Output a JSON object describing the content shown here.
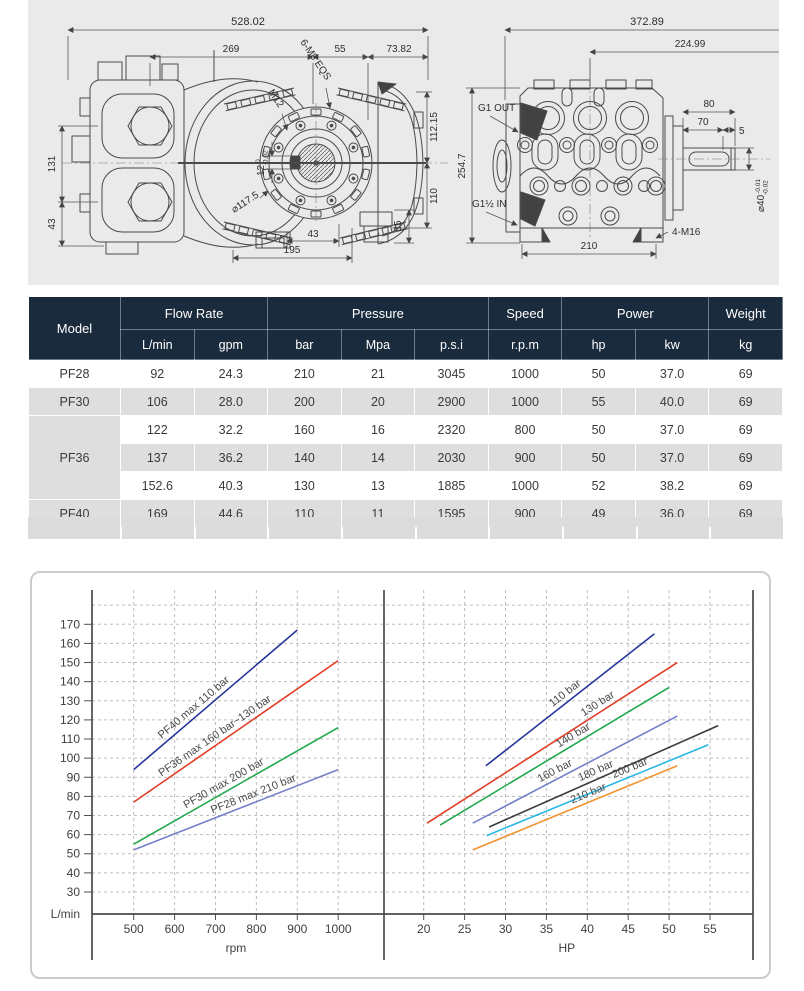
{
  "drawings": {
    "side_view": {
      "dim_overall_length": "528.02",
      "dim_mid_length": "269",
      "dim_flange_offset": "55",
      "dim_end_length": "73.82",
      "dim_left_height": "131",
      "dim_left_foot": "43",
      "dim_right_upper": "112.15",
      "dim_right_lower": "110",
      "dim_foot_height": "35",
      "dim_bottom_small": "43",
      "dim_bottom_span": "195",
      "label_bolt_pattern": "6-M8 EQS",
      "label_thread": "M12",
      "label_flange_dia": "⌀117.5",
      "label_key_width": "12",
      "label_key_tol_upper": "0",
      "label_key_tol_lower": "-0.02"
    },
    "front_view": {
      "dim_overall_width": "372.89",
      "dim_inner_width": "224.99",
      "dim_overall_height": "254.7",
      "dim_shaft_length": "80",
      "dim_key_length": "70",
      "dim_shaft_end": "5",
      "label_shaft_dia": "⌀40",
      "label_shaft_tol_upper": "-0.01",
      "label_shaft_tol_lower": "-0.02",
      "label_outlet": "G1 OUT",
      "label_inlet": "G1½ IN",
      "label_foot_bolts": "4-M16",
      "dim_foot_span": "210"
    }
  },
  "table": {
    "header_color": "#1b2b3e",
    "groups": {
      "model": "Model",
      "flow": "Flow Rate",
      "pressure": "Pressure",
      "speed": "Speed",
      "power": "Power",
      "weight": "Weight"
    },
    "units": [
      "L/min",
      "gpm",
      "bar",
      "Mpa",
      "p.s.i",
      "r.p.m",
      "hp",
      "kw",
      "kg"
    ],
    "rows": [
      {
        "model": "PF28",
        "values": [
          [
            "92",
            "24.3",
            "210",
            "21",
            "3045",
            "1000",
            "50",
            "37.0",
            "69"
          ]
        ]
      },
      {
        "model": "PF30",
        "values": [
          [
            "106",
            "28.0",
            "200",
            "20",
            "2900",
            "1000",
            "55",
            "40.0",
            "69"
          ]
        ]
      },
      {
        "model": "PF36",
        "values": [
          [
            "122",
            "32.2",
            "160",
            "16",
            "2320",
            "800",
            "50",
            "37.0",
            "69"
          ],
          [
            "137",
            "36.2",
            "140",
            "14",
            "2030",
            "900",
            "50",
            "37.0",
            "69"
          ],
          [
            "152.6",
            "40.3",
            "130",
            "13",
            "1885",
            "1000",
            "52",
            "38.2",
            "69"
          ]
        ]
      },
      {
        "model": "PF40",
        "values": [
          [
            "169",
            "44.6",
            "110",
            "11",
            "1595",
            "900",
            "49",
            "36.0",
            "69"
          ]
        ]
      }
    ]
  },
  "chart_data": [
    {
      "type": "line",
      "panel": "left",
      "xlabel": "rpm",
      "ylabel": "L/min",
      "x_ticks": [
        500,
        600,
        700,
        800,
        900,
        1000
      ],
      "y_ticks": [
        30,
        40,
        50,
        60,
        70,
        80,
        90,
        100,
        110,
        120,
        130,
        140,
        150,
        160,
        170
      ],
      "xlim": [
        400,
        1110
      ],
      "ylim": [
        18,
        188
      ],
      "grid": true,
      "series": [
        {
          "name": "PF40 max 110 bar",
          "color": "#26349b",
          "points": [
            [
              500,
              94
            ],
            [
              900,
              167
            ]
          ],
          "label_t": 0.4
        },
        {
          "name": "PF36 max 160 bar~130 bar",
          "color": "#e23c27",
          "points": [
            [
              500,
              77
            ],
            [
              1000,
              151
            ]
          ],
          "label_t": 0.42
        },
        {
          "name": "PF30 max 200 bar",
          "color": "#21a84c",
          "points": [
            [
              500,
              55
            ],
            [
              1000,
              116
            ]
          ],
          "label_t": 0.46
        },
        {
          "name": "PF28 max 210 bar",
          "color": "#7480c9",
          "points": [
            [
              500,
              52
            ],
            [
              1000,
              94
            ]
          ],
          "label_t": 0.6
        }
      ]
    },
    {
      "type": "line",
      "panel": "right",
      "xlabel": "HP",
      "ylabel": "L/min",
      "x_ticks": [
        20,
        25,
        30,
        35,
        40,
        45,
        50,
        55
      ],
      "y_ticks": [
        30,
        40,
        50,
        60,
        70,
        80,
        90,
        100,
        110,
        120,
        130,
        140,
        150,
        160,
        170
      ],
      "xlim": [
        15,
        60.5
      ],
      "ylim": [
        18,
        188
      ],
      "grid": true,
      "series": [
        {
          "name": "110 bar",
          "color": "#26349b",
          "points": [
            [
              27.6,
              96
            ],
            [
              48.2,
              165
            ]
          ],
          "label_t": 0.5
        },
        {
          "name": "130 bar",
          "color": "#e23c27",
          "points": [
            [
              20.4,
              66
            ],
            [
              51,
              150
            ]
          ],
          "label_t": 0.7
        },
        {
          "name": "140 bar",
          "color": "#21a84c",
          "points": [
            [
              22,
              65
            ],
            [
              50,
              137
            ]
          ],
          "label_t": 0.6
        },
        {
          "name": "160 bar",
          "color": "#7480c9",
          "points": [
            [
              26,
              66
            ],
            [
              51,
              122
            ]
          ],
          "label_t": 0.42
        },
        {
          "name": "180 bar",
          "color": "#3b3b3b",
          "points": [
            [
              28,
              64
            ],
            [
              56,
              117
            ]
          ],
          "label_t": 0.48
        },
        {
          "name": "200 bar",
          "color": "#2ab8e8",
          "points": [
            [
              27.7,
              59.5
            ],
            [
              54.8,
              107
            ]
          ],
          "label_t": 0.66
        },
        {
          "name": "210 bar",
          "color": "#f3922f",
          "points": [
            [
              26,
              52
            ],
            [
              51,
              96
            ]
          ],
          "label_t": 0.58
        }
      ]
    }
  ]
}
